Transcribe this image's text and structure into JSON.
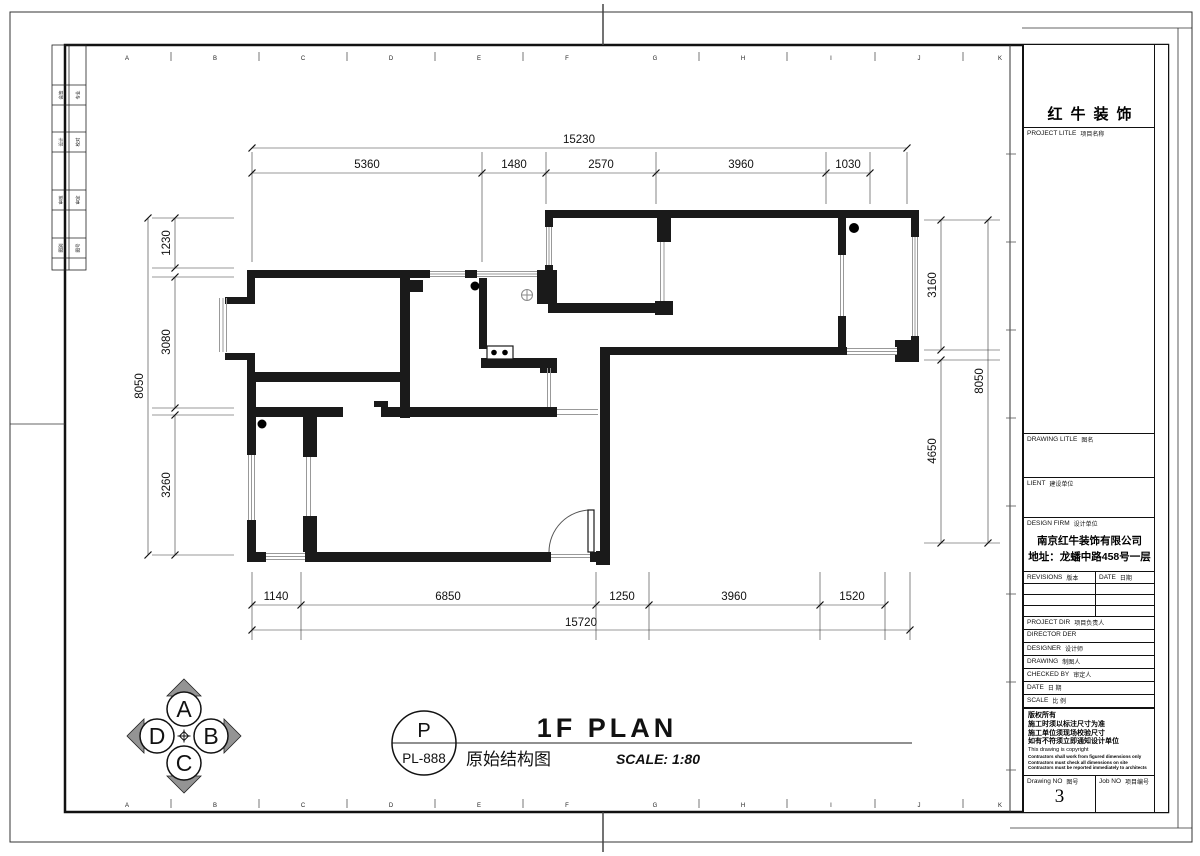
{
  "page": {
    "background": "#ffffff",
    "wall_color": "#1a1a1a",
    "window_line_color": "#999999",
    "compass_arrow_color": "#949494"
  },
  "frame": {
    "grid_letters": [
      "A",
      "B",
      "C",
      "D",
      "E",
      "F",
      "G",
      "H",
      "I",
      "J",
      "K"
    ]
  },
  "side_strip": {
    "rows": [
      {
        "a": "会签",
        "b": "专业"
      },
      {
        "a": "设计",
        "b": "校对"
      },
      {
        "a": "审核",
        "b": "审定"
      },
      {
        "a": "图别",
        "b": "图号"
      }
    ]
  },
  "dims": {
    "top_overall": "15230",
    "top_segments": [
      "5360",
      "1480",
      "2570",
      "3960",
      "1030"
    ],
    "left_overall": "8050",
    "left_segments": [
      "1230",
      "3080",
      "3260"
    ],
    "right_overall": "8050",
    "right_segments": [
      "3160",
      "4650"
    ],
    "bottom_overall": "15720",
    "bottom_segments": [
      "1140",
      "6850",
      "1250",
      "3960",
      "1520"
    ]
  },
  "titlebar": {
    "stamp_letter": "P",
    "stamp_code": "PL-888",
    "plan_title": "1F PLAN",
    "plan_subtitle": "原始结构图",
    "scale_text": "SCALE: 1:80"
  },
  "compass": {
    "top": "A",
    "right": "B",
    "bottom": "C",
    "left": "D"
  },
  "titleblock": {
    "company": "红牛装饰",
    "project_title_en": "PROJECT LITLE",
    "project_title_cn": "项目名称",
    "drawing_title_en": "DRAWING LITLE",
    "drawing_title_cn": "图名",
    "client_en": "LIENT",
    "client_cn": "建设单位",
    "design_firm_en": "DESIGN FIRM",
    "design_firm_cn": "设计单位",
    "firm_name": "南京红牛装饰有限公司",
    "firm_address": "地址：龙蟠中路458号一层",
    "revisions_en": "REVISIONS",
    "revisions_cn": "版本",
    "date_en": "DATE",
    "date_cn": "日期",
    "project_dir_en": "PROJECT DIR",
    "project_dir_cn": "项目负责人",
    "director_en": "DIRECTOR DER",
    "designer_en": "DESIGNER",
    "designer_cn": "设计师",
    "drawing_en": "DRAWING",
    "drawing_cn": "制图人",
    "checked_en": "CHECKED BY",
    "checked_cn": "审定人",
    "date2_en": "DATE",
    "date2_cn": "日 期",
    "scale_en": "SCALE",
    "scale_cn": "比 例",
    "copyright_lines": [
      "版权所有",
      "施工时须以标注尺寸为准",
      "施工单位须现场校验尺寸",
      "如有不符须立即通知设计单位",
      "This drawing is copyright",
      "Contractors shall work from figured dimensions only",
      "Contractors must check all dimensions on site",
      "Contractors must be reported immediately to architects"
    ],
    "drawing_no_en": "Drawing NO",
    "drawing_no_cn": "图号",
    "drawing_no_value": "3",
    "job_no_en": "Job NO",
    "job_no_cn": "项目编号"
  }
}
